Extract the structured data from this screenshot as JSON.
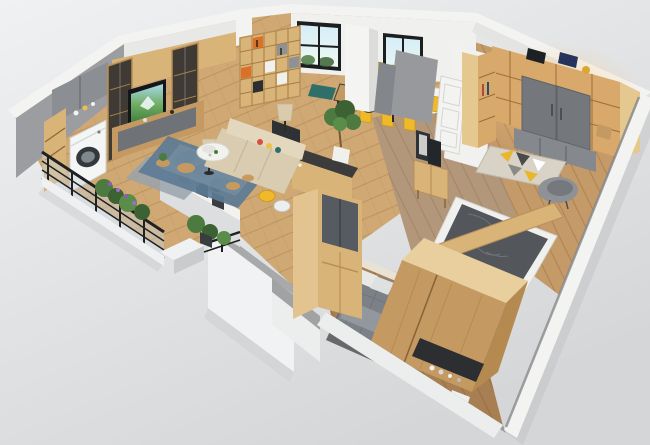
{
  "scene": {
    "title": "3D isometric cutaway render of a furnished apartment floor plan",
    "render_style": "photorealistic dollhouse view, no on-screen text",
    "rooms": [
      {
        "name": "balcony",
        "items": [
          "black-metal-glass-railing",
          "potted-plants",
          "purple-flowering-plants",
          "white-parapet-walls"
        ]
      },
      {
        "name": "laundry-nook",
        "items": [
          "white-washing-machine",
          "gray-upper-cabinet",
          "wood-open-shelving"
        ]
      },
      {
        "name": "living-room",
        "items": [
          "tv-wall-unit",
          "wall-tv-with-green-landscape",
          "dark-glass-display-cabinets",
          "beige-three-seat-sofa",
          "blue-gray-layered-rug",
          "white-round-coffee-table",
          "drum-shade-floor-lamps",
          "wood-stools",
          "planter-half-wall"
        ]
      },
      {
        "name": "dining-area",
        "items": [
          "white-dining-table",
          "yellow-dining-chairs",
          "teal-tableware",
          "cube-bookshelf-orange-accents",
          "black-frame-windows",
          "wood-desk",
          "teal-window-bench"
        ]
      },
      {
        "name": "kitchen",
        "items": [
          "wood-island-dark-counter",
          "tall-smoked-glass-cabinet",
          "potted-tree",
          "breakfast-stools"
        ]
      },
      {
        "name": "hallway",
        "items": [
          "wood-sideboard",
          "leaning-picture-frames",
          "white-paneled-door",
          "gray-partition-panels"
        ]
      },
      {
        "name": "cloakroom-study",
        "items": [
          "wraparound-wood-wardrobe-wall",
          "gray-sliding-wardrobe-doors",
          "warm-shelf-lighting",
          "geometric-triangle-rug",
          "gray-shell-armchair",
          "wood-stool"
        ]
      },
      {
        "name": "bathroom",
        "items": [
          "sunken-dark-marble-floor",
          "wood-partition-top"
        ]
      },
      {
        "name": "bedroom",
        "items": [
          "gray-quilted-bed",
          "large-wood-wardrobe-block",
          "dark-vanity-with-bottles",
          "dark-gray-rug"
        ]
      }
    ],
    "palette": {
      "bg_top": "#f0f1f2",
      "bg_bottom": "#d4d6d8",
      "wood_floor": "#cfa873",
      "floor_right": "#c49a68",
      "floor_hall": "#b3977a",
      "floor_bedroom": "#a87f52",
      "wall_white": "#f3f3f2",
      "wall_gray": "#a7a9ab",
      "wall_face_light": "#f0f0ee",
      "wood_cabinet": "#d9b478",
      "wood_deep": "#c49a62",
      "glass_dark": "#565b61",
      "sofa_beige": "#d9ccb1",
      "rug_blue": "#5d7b95",
      "rug_beige": "#d9d3c7",
      "chair_yellow": "#efb92a",
      "accent_orange": "#dd7029",
      "accent_teal": "#2f6f6a",
      "marble_dark": "#53565a",
      "bed_gray": "#7b8187",
      "railing_black": "#1f2022",
      "plant_green": "#4d7a40",
      "wardrobe_gray": "#74777c",
      "lamp_shade": "#d9cbac",
      "washer_white": "#f4f5f5",
      "vanity_dark": "#2c2e31"
    }
  }
}
